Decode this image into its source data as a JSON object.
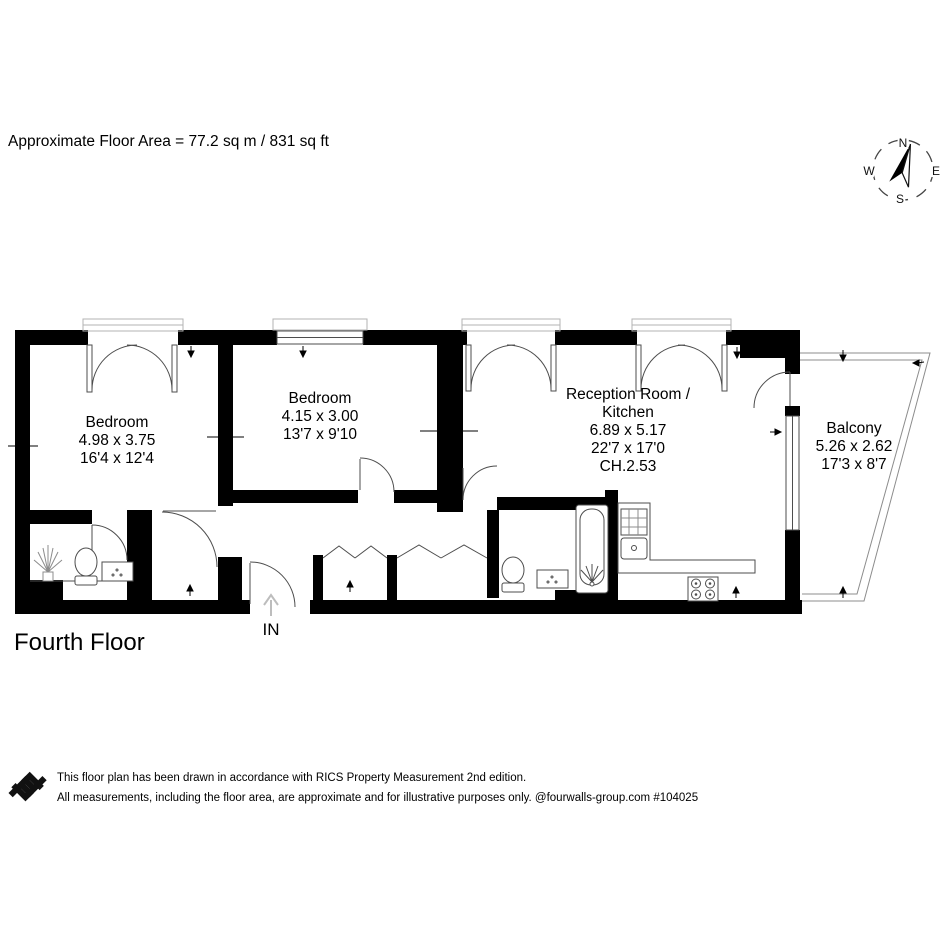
{
  "header": {
    "floor_area_label": "Approximate Floor Area = 77.2 sq m / 831 sq ft"
  },
  "compass": {
    "n": "N",
    "e": "E",
    "s": "S",
    "w": "W"
  },
  "rooms": [
    {
      "id": "bedroom-1",
      "lines": [
        "Bedroom",
        "4.98 x 3.75",
        "16'4 x 12'4"
      ]
    },
    {
      "id": "bedroom-2",
      "lines": [
        "Bedroom",
        "4.15 x 3.00",
        "13'7 x 9'10"
      ]
    },
    {
      "id": "reception-kitchen",
      "lines": [
        "Reception Room /",
        "Kitchen",
        "6.89 x 5.17",
        "22'7 x 17'0",
        "CH.2.53"
      ]
    },
    {
      "id": "balcony",
      "lines": [
        "Balcony",
        "5.26 x 2.62",
        "17'3 x 8'7"
      ]
    }
  ],
  "entrance": {
    "label": "IN"
  },
  "floor_title": "Fourth Floor",
  "footer": {
    "line1": "This floor plan has been drawn in accordance with RICS Property Measurement 2nd edition.",
    "line2": "All measurements, including the floor area, are approximate and for illustrative purposes only. @fourwalls-group.com #104025"
  },
  "colors": {
    "wall": "#000000",
    "thin_line": "#4d4d4d",
    "light_line": "#a8a8a8",
    "background": "#ffffff"
  }
}
